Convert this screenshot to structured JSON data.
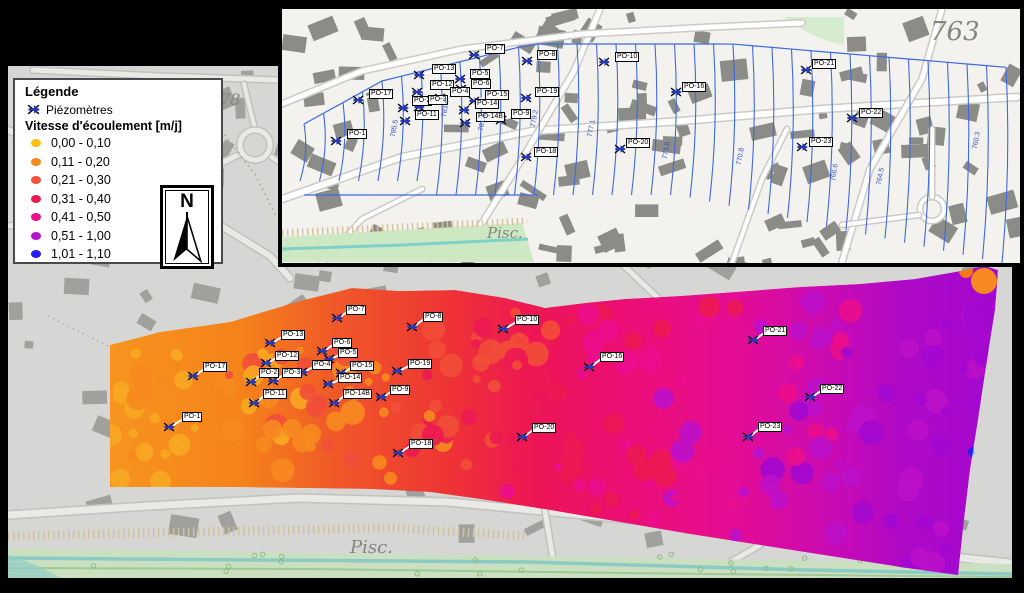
{
  "legend": {
    "title": "Légende",
    "piezometers_label": "Piézomètres",
    "velocity_title": "Vitesse d'écoulement [m/j]",
    "classes": [
      {
        "range": "0,00 - 0,10",
        "color": "#FFC20E"
      },
      {
        "range": "0,11 - 0,20",
        "color": "#F6891F"
      },
      {
        "range": "0,21 - 0,30",
        "color": "#F1503A"
      },
      {
        "range": "0,31 - 0,40",
        "color": "#EC1A52"
      },
      {
        "range": "0,41 - 0,50",
        "color": "#EB0D8C"
      },
      {
        "range": "0,51 - 1,00",
        "color": "#B611CE"
      },
      {
        "range": "1,01 - 1,10",
        "color": "#2B1CF2"
      }
    ]
  },
  "north_arrow": {
    "label": "N"
  },
  "inset_map": {
    "contour_labels": [
      {
        "text": "785.5",
        "x": 104,
        "y": 116
      },
      {
        "text": "783.4",
        "x": 155,
        "y": 96
      },
      {
        "text": "781.4",
        "x": 192,
        "y": 110
      },
      {
        "text": "779.2",
        "x": 244,
        "y": 106
      },
      {
        "text": "777.1",
        "x": 301,
        "y": 116
      },
      {
        "text": "773.8",
        "x": 376,
        "y": 138
      },
      {
        "text": "770.8",
        "x": 450,
        "y": 144
      },
      {
        "text": "766.6",
        "x": 544,
        "y": 160
      },
      {
        "text": "764.5",
        "x": 590,
        "y": 164
      },
      {
        "text": "760.3",
        "x": 686,
        "y": 128
      }
    ],
    "place_labels": [
      {
        "text": "Pisc.",
        "x": 205,
        "y": 215,
        "size": 15
      },
      {
        "text": "763",
        "x": 648,
        "y": 8,
        "size": 26
      }
    ],
    "piezometers": [
      {
        "id": "PO-7",
        "x": 192,
        "y": 46,
        "lx": 204,
        "ly": 37
      },
      {
        "id": "PO-13",
        "x": 137,
        "y": 66,
        "lx": 151,
        "ly": 57
      },
      {
        "id": "PO-5",
        "x": 178,
        "y": 70,
        "lx": 189,
        "ly": 62
      },
      {
        "id": "PO-6",
        "x": 179,
        "y": 80,
        "lx": 190,
        "ly": 72
      },
      {
        "id": "PO-12",
        "x": 135,
        "y": 83,
        "lx": 149,
        "ly": 73
      },
      {
        "id": "PO-4",
        "x": 158,
        "y": 89,
        "lx": 169,
        "ly": 80
      },
      {
        "id": "PO-15",
        "x": 192,
        "y": 92,
        "lx": 204,
        "ly": 83
      },
      {
        "id": "PO-17",
        "x": 76,
        "y": 91,
        "lx": 88,
        "ly": 82
      },
      {
        "id": "PO-2",
        "x": 121,
        "y": 99,
        "lx": 131,
        "ly": 89
      },
      {
        "id": "PO-3",
        "x": 137,
        "y": 98,
        "lx": 147,
        "ly": 88
      },
      {
        "id": "PO-14",
        "x": 182,
        "y": 101,
        "lx": 194,
        "ly": 92
      },
      {
        "id": "PO-11",
        "x": 123,
        "y": 112,
        "lx": 134,
        "ly": 103
      },
      {
        "id": "PO-14B",
        "x": 183,
        "y": 114,
        "lx": 195,
        "ly": 105
      },
      {
        "id": "PO-9",
        "x": 219,
        "y": 111,
        "lx": 230,
        "ly": 102
      },
      {
        "id": "PO-1",
        "x": 54,
        "y": 132,
        "lx": 66,
        "ly": 122
      },
      {
        "id": "PO-8",
        "x": 245,
        "y": 52,
        "lx": 256,
        "ly": 43
      },
      {
        "id": "PO-10",
        "x": 322,
        "y": 53,
        "lx": 334,
        "ly": 45
      },
      {
        "id": "PO-19",
        "x": 244,
        "y": 89,
        "lx": 254,
        "ly": 80
      },
      {
        "id": "PO-16",
        "x": 394,
        "y": 83,
        "lx": 401,
        "ly": 75
      },
      {
        "id": "PO-18",
        "x": 244,
        "y": 148,
        "lx": 253,
        "ly": 140
      },
      {
        "id": "PO-20",
        "x": 338,
        "y": 140,
        "lx": 345,
        "ly": 131
      },
      {
        "id": "PO-21",
        "x": 524,
        "y": 61,
        "lx": 531,
        "ly": 52
      },
      {
        "id": "PO-22",
        "x": 570,
        "y": 109,
        "lx": 578,
        "ly": 101
      },
      {
        "id": "PO-23",
        "x": 520,
        "y": 138,
        "lx": 528,
        "ly": 130
      }
    ]
  },
  "main_map": {
    "place_labels": [
      {
        "text": "Pisc.",
        "x": 350,
        "y": 537,
        "size": 18
      },
      {
        "text": "78",
        "x": 220,
        "y": 90,
        "size": 16
      }
    ],
    "flow_anomaly_dot": {
      "x": 973,
      "y": 452,
      "color": "#2323EE"
    },
    "piezometers": [
      {
        "id": "PO-7",
        "x": 337,
        "y": 318,
        "lx": 347,
        "ly": 307
      },
      {
        "id": "PO-13",
        "x": 270,
        "y": 343,
        "lx": 282,
        "ly": 332
      },
      {
        "id": "PO-12",
        "x": 266,
        "y": 363,
        "lx": 276,
        "ly": 353
      },
      {
        "id": "PO-6",
        "x": 322,
        "y": 351,
        "lx": 333,
        "ly": 340
      },
      {
        "id": "PO-5",
        "x": 329,
        "y": 359,
        "lx": 339,
        "ly": 350
      },
      {
        "id": "PO-4",
        "x": 302,
        "y": 372,
        "lx": 313,
        "ly": 362
      },
      {
        "id": "PO-15",
        "x": 341,
        "y": 373,
        "lx": 351,
        "ly": 363
      },
      {
        "id": "PO-17",
        "x": 193,
        "y": 376,
        "lx": 204,
        "ly": 364
      },
      {
        "id": "PO-2",
        "x": 251,
        "y": 382,
        "lx": 260,
        "ly": 370
      },
      {
        "id": "PO-3",
        "x": 273,
        "y": 381,
        "lx": 283,
        "ly": 370
      },
      {
        "id": "PO-14",
        "x": 328,
        "y": 384,
        "lx": 339,
        "ly": 375
      },
      {
        "id": "PO-14B",
        "x": 334,
        "y": 403,
        "lx": 344,
        "ly": 391
      },
      {
        "id": "PO-11",
        "x": 254,
        "y": 403,
        "lx": 264,
        "ly": 391
      },
      {
        "id": "PO-9",
        "x": 381,
        "y": 397,
        "lx": 391,
        "ly": 387
      },
      {
        "id": "PO-19",
        "x": 397,
        "y": 371,
        "lx": 409,
        "ly": 361
      },
      {
        "id": "PO-1",
        "x": 169,
        "y": 427,
        "lx": 183,
        "ly": 414
      },
      {
        "id": "PO-8",
        "x": 412,
        "y": 327,
        "lx": 424,
        "ly": 314
      },
      {
        "id": "PO-10",
        "x": 503,
        "y": 329,
        "lx": 516,
        "ly": 317
      },
      {
        "id": "PO-18",
        "x": 398,
        "y": 453,
        "lx": 410,
        "ly": 441
      },
      {
        "id": "PO-16",
        "x": 589,
        "y": 367,
        "lx": 601,
        "ly": 354
      },
      {
        "id": "PO-20",
        "x": 522,
        "y": 437,
        "lx": 533,
        "ly": 425
      },
      {
        "id": "PO-21",
        "x": 753,
        "y": 340,
        "lx": 764,
        "ly": 328
      },
      {
        "id": "PO-22",
        "x": 810,
        "y": 397,
        "lx": 821,
        "ly": 386
      },
      {
        "id": "PO-23",
        "x": 748,
        "y": 437,
        "lx": 759,
        "ly": 424
      }
    ]
  }
}
